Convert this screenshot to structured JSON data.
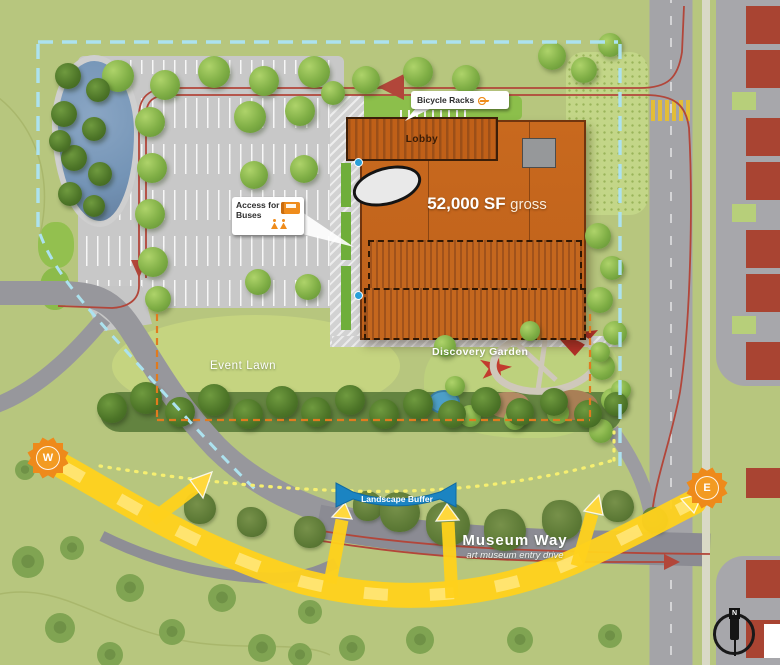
{
  "plan": {
    "building": {
      "lobby": "Lobby",
      "area_bold": "52,000 SF",
      "area_light": "gross"
    },
    "callouts": {
      "bicycle_racks": "Bicycle Racks",
      "access_line1": "Access for",
      "access_line2": "Buses"
    },
    "areas": {
      "event_lawn": "Event Lawn",
      "discovery_garden": "Discovery Garden",
      "landscape_buffer": "Landscape Buffer"
    },
    "road": {
      "name": "Museum Way",
      "subtitle": "art museum entry drive"
    },
    "markers": {
      "sun_west": "W",
      "sun_east": "E",
      "compass_north": "N"
    },
    "colors": {
      "field_green": "#b7c67e",
      "building_orange": "#c4661d",
      "neighbor_red": "#a94432",
      "route_red": "#b2463a",
      "view_yellow": "#ffd21c",
      "property_line_cyan": "#ace2ef",
      "program_line_orange": "#e07b1f",
      "lawn_line_yellow": "#f6ef70",
      "water_blue": "#7494b6",
      "banner_blue": "#1b84c2",
      "sun_orange": "#f39b22",
      "road_gray": "#97979c"
    },
    "trees": {
      "canopy": [
        [
          118,
          76,
          16
        ],
        [
          165,
          85,
          15
        ],
        [
          214,
          72,
          16
        ],
        [
          264,
          81,
          15
        ],
        [
          314,
          72,
          16
        ],
        [
          366,
          80,
          14
        ],
        [
          418,
          72,
          15
        ],
        [
          466,
          79,
          14
        ],
        [
          552,
          56,
          14
        ],
        [
          584,
          70,
          13
        ],
        [
          610,
          45,
          12
        ],
        [
          150,
          122,
          15
        ],
        [
          152,
          168,
          15
        ],
        [
          150,
          214,
          15
        ],
        [
          153,
          262,
          15
        ],
        [
          158,
          299,
          13
        ],
        [
          250,
          117,
          16
        ],
        [
          300,
          111,
          15
        ],
        [
          254,
          175,
          14
        ],
        [
          304,
          169,
          14
        ],
        [
          258,
          282,
          13
        ],
        [
          308,
          287,
          13
        ],
        [
          333,
          93,
          12
        ],
        [
          598,
          236,
          13
        ],
        [
          612,
          268,
          12
        ],
        [
          600,
          300,
          13
        ],
        [
          615,
          333,
          12
        ],
        [
          602,
          367,
          13
        ],
        [
          613,
          400,
          12
        ],
        [
          601,
          431,
          12
        ],
        [
          445,
          346,
          11
        ],
        [
          470,
          416,
          11
        ],
        [
          515,
          419,
          11
        ],
        [
          558,
          413,
          11
        ],
        [
          600,
          352,
          10
        ],
        [
          621,
          390,
          10
        ],
        [
          455,
          386,
          10
        ],
        [
          530,
          331,
          10
        ]
      ],
      "dark": [
        [
          68,
          76,
          13
        ],
        [
          98,
          90,
          12
        ],
        [
          64,
          114,
          13
        ],
        [
          94,
          129,
          12
        ],
        [
          74,
          158,
          13
        ],
        [
          100,
          174,
          12
        ],
        [
          70,
          194,
          12
        ],
        [
          94,
          206,
          11
        ],
        [
          60,
          141,
          11
        ],
        [
          112,
          408,
          15
        ],
        [
          146,
          398,
          16
        ],
        [
          180,
          412,
          15
        ],
        [
          214,
          400,
          16
        ],
        [
          248,
          414,
          15
        ],
        [
          282,
          402,
          16
        ],
        [
          316,
          412,
          15
        ],
        [
          350,
          400,
          15
        ],
        [
          384,
          414,
          15
        ],
        [
          418,
          404,
          15
        ],
        [
          452,
          414,
          14
        ],
        [
          486,
          402,
          15
        ],
        [
          520,
          412,
          14
        ],
        [
          554,
          402,
          14
        ],
        [
          588,
          414,
          14
        ],
        [
          616,
          404,
          12
        ]
      ],
      "olive": [
        [
          200,
          508,
          16
        ],
        [
          252,
          522,
          15
        ],
        [
          310,
          532,
          16
        ],
        [
          368,
          506,
          15
        ],
        [
          400,
          512,
          20
        ],
        [
          448,
          524,
          22
        ],
        [
          505,
          530,
          21
        ],
        [
          562,
          520,
          20
        ],
        [
          618,
          506,
          16
        ],
        [
          655,
          520,
          13
        ]
      ],
      "flat": [
        [
          28,
          562,
          16
        ],
        [
          72,
          548,
          12
        ],
        [
          130,
          588,
          14
        ],
        [
          222,
          598,
          14
        ],
        [
          172,
          632,
          13
        ],
        [
          60,
          628,
          15
        ],
        [
          110,
          655,
          13
        ],
        [
          262,
          648,
          14
        ],
        [
          310,
          612,
          12
        ],
        [
          352,
          648,
          13
        ],
        [
          420,
          640,
          14
        ],
        [
          300,
          655,
          12
        ],
        [
          25,
          470,
          10
        ],
        [
          520,
          640,
          13
        ],
        [
          610,
          636,
          12
        ]
      ]
    }
  }
}
